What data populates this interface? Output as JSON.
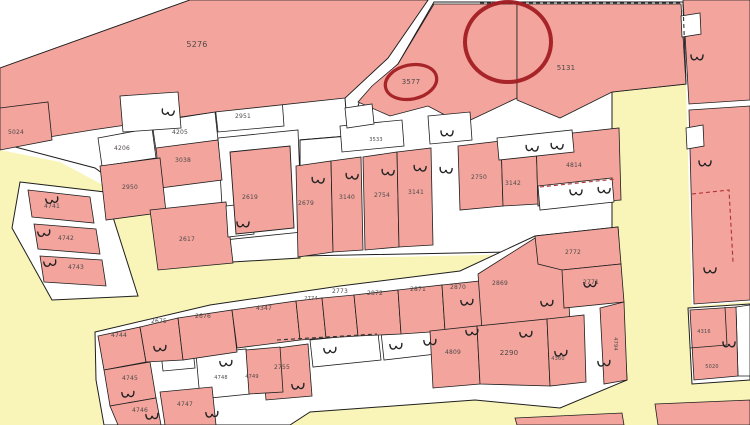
{
  "map_title": "cadastral parcel map",
  "palette": {
    "background": "#ffffff",
    "road": "#f9f5b8",
    "parcel_pink": "#f2a49d",
    "building_white": "#ffffff",
    "border": "#1e1e1e",
    "label": "#4e4a48",
    "dash_red": "#b03030",
    "dash_black": "#333333",
    "annotation": "#a21d23"
  },
  "roads": [
    {
      "name": "road-network",
      "points": "0,150 60,162 150,210 240,253 345,258 612,252 612,90 686,84 692,306 750,302 750,425 0,425"
    }
  ],
  "blocks": [
    {
      "name": "top-block-base",
      "points": "0,68 190,0 428,0 388,58 345,98 348,136 300,140 300,258 232,262 150,208 95,168 0,143"
    },
    {
      "name": "middle-block-base",
      "points": "398,64 434,2 683,2 686,84 612,92 612,250 300,256 300,140 348,136 360,100"
    },
    {
      "name": "wedge-block-base",
      "points": "20,182 105,192 138,296 52,300 12,228"
    },
    {
      "name": "bottom-block-base",
      "points": "95,332 210,305 340,286 460,271 535,236 618,227 627,380 560,408 475,400 310,412 290,425 104,425 96,380"
    },
    {
      "name": "corner-block-base",
      "points": "688,308 750,304 750,380 692,384"
    }
  ],
  "white_parcels": [
    {
      "name": "parcel-2951-cell",
      "points": "215,105 282,98 284,126 218,132"
    },
    {
      "name": "parcel-4205-cell",
      "points": "152,122 215,112 218,140 156,150"
    },
    {
      "name": "parcel-4206-cell",
      "points": "98,138 152,128 156,158 102,166"
    },
    {
      "name": "parcel-2619-yard",
      "points": "218,138 298,130 302,232 224,240"
    },
    {
      "name": "compound-cell-a",
      "points": "196,354 246,349 250,394 200,399"
    },
    {
      "name": "compound-cell-b",
      "points": "310,340 378,333 381,360 313,367"
    },
    {
      "name": "compound-cell-c",
      "points": "381,332 433,326 436,354 384,360"
    },
    {
      "name": "compound-cell-d",
      "points": "456,302 482,299 484,324 458,327"
    },
    {
      "name": "compound-cell-e",
      "points": "516,294 546,291 548,318 518,321"
    },
    {
      "name": "compound-cell-f",
      "points": "160,344 192,341 195,368 163,371"
    },
    {
      "name": "corner-cell-white",
      "points": "736,307 750,305 750,376 738,376"
    }
  ],
  "parcels": [
    {
      "label": "5276",
      "points": "0,68 190,0 428,0 388,58 345,98 215,112 92,130 0,145"
    },
    {
      "label": "5024",
      "points": "0,108 48,102 52,140 0,150"
    },
    {
      "label": "3038",
      "points": "156,148 218,140 222,180 160,188"
    },
    {
      "label": "2950",
      "points": "100,166 160,158 166,212 106,220"
    },
    {
      "label": "2617",
      "points": "150,210 226,202 233,263 158,270"
    },
    {
      "label": "4741",
      "points": "28,190 90,197 94,223 32,217"
    },
    {
      "label": "4742",
      "points": "34,224 96,229 100,254 38,249"
    },
    {
      "label": "4743",
      "points": "40,256 102,260 106,286 44,282"
    },
    {
      "label": "3577",
      "points": "398,64 434,4 517,4 517,98 462,124 428,106 390,116 358,102 372,86"
    },
    {
      "label": "5131",
      "points": "517,4 681,4 686,84 612,92 560,118 517,100"
    },
    {
      "label": "2679",
      "points": "296,166 331,161 333,252 298,257"
    },
    {
      "label": "3140",
      "points": "331,161 361,157 363,250 333,252"
    },
    {
      "label": "2754",
      "points": "363,157 397,152 399,247 365,250"
    },
    {
      "label": "3141",
      "points": "397,152 431,148 433,245 399,247"
    },
    {
      "label": "2750",
      "points": "458,146 501,141 503,206 460,210"
    },
    {
      "label": "3142",
      "points": "501,141 536,137 538,204 503,206"
    },
    {
      "label": "4814",
      "points": "536,137 619,128 621,200 538,206"
    },
    {
      "label": "4744",
      "points": "98,336 140,327 146,362 104,370"
    },
    {
      "label": "2675",
      "points": "140,327 178,318 183,360 146,362"
    },
    {
      "label": "2676",
      "points": "178,318 232,310 237,352 183,360"
    },
    {
      "label": "4347",
      "points": "232,310 296,301 300,340 237,348"
    },
    {
      "label": "2774",
      "points": "296,301 322,298 326,338 300,340"
    },
    {
      "label": "2773",
      "points": "322,298 354,295 358,336 326,338"
    },
    {
      "label": "2872",
      "points": "354,295 398,290 401,334 358,336"
    },
    {
      "label": "2871",
      "points": "398,290 442,285 445,331 401,334"
    },
    {
      "label": "2870",
      "points": "442,285 480,281 483,329 445,331"
    },
    {
      "label": "2869",
      "points": "478,274 535,238 566,234 570,326 482,330"
    },
    {
      "label": "2772",
      "points": "535,236 618,227 621,264 562,270 538,264"
    },
    {
      "label": "2771",
      "points": "562,270 621,264 624,302 564,308"
    },
    {
      "label": "4794",
      "points": "600,308 624,302 627,380 604,384"
    },
    {
      "label": "4809",
      "points": "430,331 477,326 480,384 433,388"
    },
    {
      "label": "2290",
      "points": "477,326 547,319 550,386 480,384"
    },
    {
      "label": "4360",
      "points": "547,319 584,315 586,382 550,386"
    },
    {
      "label": "2755",
      "points": "262,350 308,344 312,396 266,400"
    },
    {
      "label": "4749",
      "points": "246,350 280,347 283,392 249,394"
    },
    {
      "label": "4745",
      "points": "104,370 150,362 156,398 110,406"
    },
    {
      "label": "4746",
      "points": "110,406 156,398 161,425 118,425"
    },
    {
      "label": "4747",
      "points": "160,392 212,387 216,425 165,425"
    },
    {
      "label": "right-strip-a",
      "points": "683,0 750,0 750,100 689,104"
    },
    {
      "label": "right-strip-b",
      "points": "689,110 750,106 750,300 694,304"
    },
    {
      "label": "4316",
      "points": "690,310 736,307 738,376 694,380"
    },
    {
      "label": "sliver-a",
      "points": "515,418 622,413 624,425 517,425"
    },
    {
      "label": "sliver-b",
      "points": "655,404 750,400 750,425 658,425"
    }
  ],
  "pink_buildings": [
    {
      "name": "building-2619",
      "points": "230,152 290,146 294,228 236,234"
    }
  ],
  "buildings": [
    {
      "name": "building",
      "points": "120,96 178,92 181,128 123,132"
    },
    {
      "name": "building",
      "points": "340,126 402,120 404,146 342,152"
    },
    {
      "name": "building",
      "points": "428,116 470,112 472,140 430,144"
    },
    {
      "name": "building",
      "points": "497,138 572,130 574,152 499,160"
    },
    {
      "name": "building",
      "points": "538,186 612,178 614,202 540,210"
    },
    {
      "name": "building",
      "points": "345,108 372,104 374,124 347,128"
    },
    {
      "name": "building",
      "points": "226,206 252,203 254,234 228,237"
    },
    {
      "name": "building",
      "points": "681,16 700,13 701,34 682,37"
    },
    {
      "name": "building",
      "points": "686,128 703,125 704,146 687,149"
    }
  ],
  "dashes": [
    {
      "name": "dashed-boundary",
      "color": "black",
      "points": "480,3 683,3"
    },
    {
      "name": "dashed-boundary",
      "color": "black",
      "points": "683,3 686,84"
    },
    {
      "name": "dashed-boundary",
      "color": "red",
      "points": "540,187 616,179"
    },
    {
      "name": "dashed-boundary",
      "color": "red",
      "points": "692,194 729,190 733,262"
    },
    {
      "name": "dashed-boundary",
      "color": "black",
      "points": "277,340 377,334"
    }
  ],
  "inner_lines": [
    {
      "name": "parcel-divider",
      "points": "690,348 727,345"
    },
    {
      "name": "parcel-divider",
      "points": "727,345 725,307"
    }
  ],
  "hooks": [
    {
      "x": 168,
      "y": 112,
      "r": 100
    },
    {
      "x": 243,
      "y": 224,
      "r": 90
    },
    {
      "x": 318,
      "y": 180,
      "r": 95
    },
    {
      "x": 352,
      "y": 176,
      "r": 95
    },
    {
      "x": 388,
      "y": 172,
      "r": 95
    },
    {
      "x": 420,
      "y": 168,
      "r": 95
    },
    {
      "x": 446,
      "y": 170,
      "r": 95
    },
    {
      "x": 447,
      "y": 133,
      "r": 90
    },
    {
      "x": 532,
      "y": 148,
      "r": 95
    },
    {
      "x": 557,
      "y": 146,
      "r": 95
    },
    {
      "x": 576,
      "y": 192,
      "r": 90
    },
    {
      "x": 604,
      "y": 190,
      "r": 95
    },
    {
      "x": 697,
      "y": 57,
      "r": 90
    },
    {
      "x": 705,
      "y": 163,
      "r": 90
    },
    {
      "x": 710,
      "y": 270,
      "r": 90
    },
    {
      "x": 729,
      "y": 344,
      "r": 90
    },
    {
      "x": 52,
      "y": 200,
      "r": 80
    },
    {
      "x": 44,
      "y": 233,
      "r": 80
    },
    {
      "x": 50,
      "y": 263,
      "r": 80
    },
    {
      "x": 160,
      "y": 348,
      "r": 85
    },
    {
      "x": 226,
      "y": 363,
      "r": 85
    },
    {
      "x": 128,
      "y": 394,
      "r": 85
    },
    {
      "x": 152,
      "y": 416,
      "r": 85
    },
    {
      "x": 212,
      "y": 414,
      "r": 85
    },
    {
      "x": 298,
      "y": 386,
      "r": 85
    },
    {
      "x": 330,
      "y": 350,
      "r": 85
    },
    {
      "x": 396,
      "y": 346,
      "r": 85
    },
    {
      "x": 430,
      "y": 342,
      "r": 85
    },
    {
      "x": 467,
      "y": 302,
      "r": 85
    },
    {
      "x": 472,
      "y": 332,
      "r": 85
    },
    {
      "x": 526,
      "y": 334,
      "r": 85
    },
    {
      "x": 547,
      "y": 303,
      "r": 85
    },
    {
      "x": 561,
      "y": 353,
      "r": 85
    },
    {
      "x": 604,
      "y": 363,
      "r": 85
    },
    {
      "x": 590,
      "y": 284,
      "r": 85
    }
  ],
  "labels": [
    {
      "t": "5276",
      "x": 197,
      "y": 47,
      "fs": 8
    },
    {
      "t": "3577",
      "x": 411,
      "y": 84,
      "fs": 7
    },
    {
      "t": "5131",
      "x": 566,
      "y": 70,
      "fs": 7
    },
    {
      "t": "5024",
      "x": 16,
      "y": 134,
      "fs": 6
    },
    {
      "t": "2951",
      "x": 243,
      "y": 118,
      "fs": 6
    },
    {
      "t": "4205",
      "x": 180,
      "y": 134,
      "fs": 6
    },
    {
      "t": "4206",
      "x": 122,
      "y": 150,
      "fs": 6
    },
    {
      "t": "3038",
      "x": 183,
      "y": 162,
      "fs": 6
    },
    {
      "t": "2950",
      "x": 130,
      "y": 189,
      "fs": 6
    },
    {
      "t": "2619",
      "x": 250,
      "y": 199,
      "fs": 6
    },
    {
      "t": "2617",
      "x": 187,
      "y": 241,
      "fs": 6
    },
    {
      "t": "4741",
      "x": 52,
      "y": 208,
      "fs": 6
    },
    {
      "t": "4742",
      "x": 66,
      "y": 240,
      "fs": 6
    },
    {
      "t": "4743",
      "x": 76,
      "y": 269,
      "fs": 6
    },
    {
      "t": "2679",
      "x": 306,
      "y": 205,
      "fs": 6
    },
    {
      "t": "3533",
      "x": 376,
      "y": 141,
      "fs": 5
    },
    {
      "t": "3140",
      "x": 347,
      "y": 199,
      "fs": 6
    },
    {
      "t": "2754",
      "x": 382,
      "y": 197,
      "fs": 6
    },
    {
      "t": "3141",
      "x": 416,
      "y": 194,
      "fs": 6
    },
    {
      "t": "2750",
      "x": 479,
      "y": 179,
      "fs": 6
    },
    {
      "t": "3142",
      "x": 513,
      "y": 185,
      "fs": 6
    },
    {
      "t": "4814",
      "x": 574,
      "y": 167,
      "fs": 6
    },
    {
      "t": "4744",
      "x": 119,
      "y": 337,
      "fs": 6
    },
    {
      "t": "2675",
      "x": 159,
      "y": 323,
      "fs": 6
    },
    {
      "t": "2676",
      "x": 203,
      "y": 318,
      "fs": 6
    },
    {
      "t": "4347",
      "x": 264,
      "y": 310,
      "fs": 6
    },
    {
      "t": "2774",
      "x": 311,
      "y": 300,
      "fs": 5
    },
    {
      "t": "2773",
      "x": 340,
      "y": 293,
      "fs": 6
    },
    {
      "t": "2872",
      "x": 375,
      "y": 295,
      "fs": 6
    },
    {
      "t": "2871",
      "x": 418,
      "y": 291,
      "fs": 6
    },
    {
      "t": "2870",
      "x": 458,
      "y": 289,
      "fs": 6
    },
    {
      "t": "2869",
      "x": 500,
      "y": 285,
      "fs": 6
    },
    {
      "t": "2772",
      "x": 573,
      "y": 254,
      "fs": 6
    },
    {
      "t": "2771",
      "x": 591,
      "y": 284,
      "fs": 6
    },
    {
      "t": "4745",
      "x": 130,
      "y": 380,
      "fs": 6
    },
    {
      "t": "4748",
      "x": 221,
      "y": 379,
      "fs": 5
    },
    {
      "t": "4749",
      "x": 252,
      "y": 378,
      "fs": 5
    },
    {
      "t": "2755",
      "x": 282,
      "y": 369,
      "fs": 6
    },
    {
      "t": "4746",
      "x": 140,
      "y": 412,
      "fs": 6
    },
    {
      "t": "4747",
      "x": 185,
      "y": 406,
      "fs": 6
    },
    {
      "t": "4809",
      "x": 453,
      "y": 354,
      "fs": 6
    },
    {
      "t": "2290",
      "x": 509,
      "y": 355,
      "fs": 7
    },
    {
      "t": "4360",
      "x": 558,
      "y": 360,
      "fs": 5
    },
    {
      "t": "4794",
      "x": 614,
      "y": 344,
      "fs": 5,
      "rot": 90
    },
    {
      "t": "4316",
      "x": 704,
      "y": 333,
      "fs": 5
    },
    {
      "t": "5020",
      "x": 712,
      "y": 368,
      "fs": 5
    }
  ],
  "annotations": {
    "circles": [
      {
        "name": "annotation-circle-small",
        "cx": 411,
        "cy": 82,
        "rx": 26,
        "ry": 17,
        "rot": -12,
        "sw": 3.2
      },
      {
        "name": "annotation-circle-large",
        "cx": 508,
        "cy": 42,
        "rx": 43,
        "ry": 40,
        "rot": 0,
        "sw": 4
      }
    ]
  }
}
